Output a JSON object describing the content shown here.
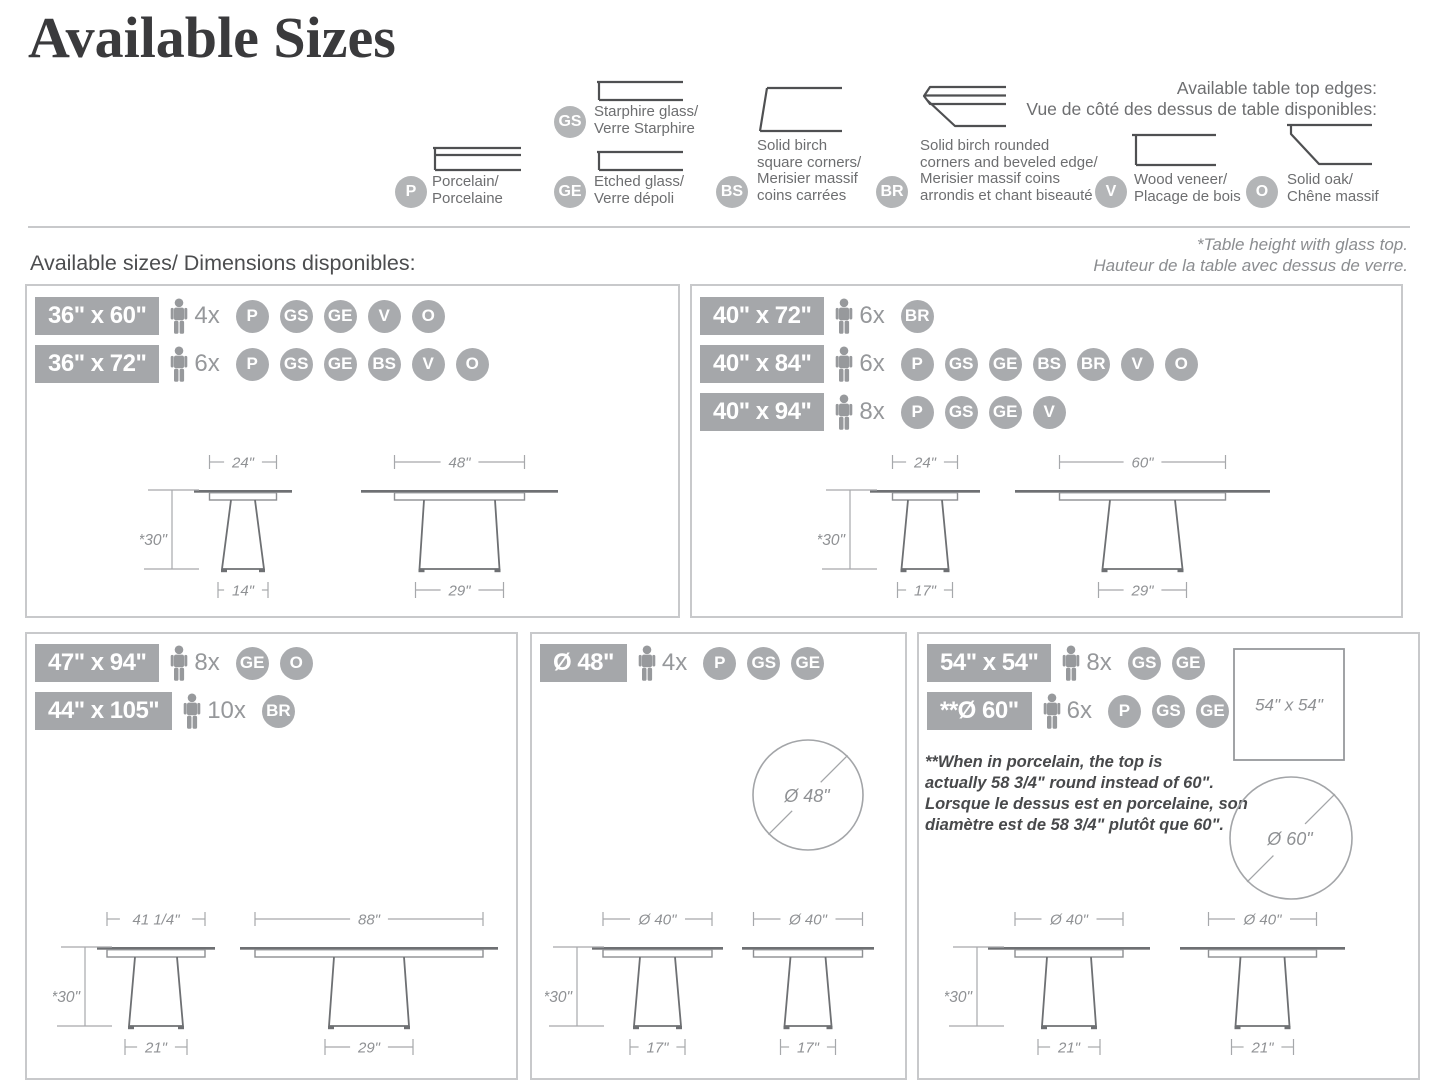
{
  "page": {
    "title": "Available Sizes",
    "section_label": "Available sizes/ Dimensions disponibles:",
    "footnote_line1": "*Table height with glass top.",
    "footnote_line2": "Hauteur de la table avec dessus de verre."
  },
  "edges_legend": {
    "heading_line1": "Available table top edges:",
    "heading_line2": "Vue de côté des dessus de table disponibles:",
    "items": [
      {
        "code": "P",
        "lines": [
          "Porcelain/",
          "Porcelaine"
        ]
      },
      {
        "code": "GS",
        "lines": [
          "Starphire glass/",
          "Verre Starphire"
        ]
      },
      {
        "code": "GE",
        "lines": [
          "Etched glass/",
          "Verre dépoli"
        ]
      },
      {
        "code": "BS",
        "lines": [
          "Solid birch",
          "square corners/",
          "Merisier massif",
          "coins carrées"
        ]
      },
      {
        "code": "BR",
        "lines": [
          "Solid birch rounded",
          "corners and beveled edge/",
          "Merisier massif coins",
          "arrondis et chant biseauté"
        ]
      },
      {
        "code": "V",
        "lines": [
          "Wood veneer/",
          "Placage de bois"
        ]
      },
      {
        "code": "O",
        "lines": [
          "Solid oak/",
          "Chêne massif"
        ]
      }
    ]
  },
  "panels": [
    {
      "rows": [
        {
          "size": "36\" x 60\"",
          "seats": "4x",
          "finishes": [
            "P",
            "GS",
            "GE",
            "V",
            "O"
          ]
        },
        {
          "size": "36\" x 72\"",
          "seats": "6x",
          "finishes": [
            "P",
            "GS",
            "GE",
            "BS",
            "V",
            "O"
          ]
        }
      ],
      "drawings": [
        {
          "type": "pedestal",
          "top": "24\"",
          "height": "*30\"",
          "base": "14\""
        },
        {
          "type": "pedestal",
          "top": "48\"",
          "base": "29\""
        }
      ]
    },
    {
      "rows": [
        {
          "size": "40\" x 72\"",
          "seats": "6x",
          "finishes": [
            "BR"
          ]
        },
        {
          "size": "40\" x 84\"",
          "seats": "6x",
          "finishes": [
            "P",
            "GS",
            "GE",
            "BS",
            "BR",
            "V",
            "O"
          ]
        },
        {
          "size": "40\" x 94\"",
          "seats": "8x",
          "finishes": [
            "P",
            "GS",
            "GE",
            "V"
          ]
        }
      ],
      "drawings": [
        {
          "type": "pedestal",
          "top": "24\"",
          "height": "*30\"",
          "base": "17\""
        },
        {
          "type": "pedestal",
          "top": "60\"",
          "base": "29\""
        }
      ]
    },
    {
      "rows": [
        {
          "size": "47\" x 94\"",
          "seats": "8x",
          "finishes": [
            "GE",
            "O"
          ]
        },
        {
          "size": "44\" x 105\"",
          "seats": "10x",
          "finishes": [
            "BR"
          ]
        }
      ],
      "drawings": [
        {
          "type": "pedestal",
          "top": "41 1/4\"",
          "height": "*30\"",
          "base": "21\""
        },
        {
          "type": "pedestal",
          "top": "88\"",
          "base": "29\""
        }
      ]
    },
    {
      "rows": [
        {
          "size": "Ø 48\"",
          "seats": "4x",
          "finishes": [
            "P",
            "GS",
            "GE"
          ]
        }
      ],
      "drawings": [
        {
          "type": "circle",
          "label": "Ø 48\""
        },
        {
          "type": "pedestal",
          "top": "Ø 40\"",
          "height": "*30\"",
          "base": "17\""
        },
        {
          "type": "pedestal",
          "top": "Ø 40\"",
          "base": "17\""
        }
      ]
    },
    {
      "rows": [
        {
          "size": "54\" x 54\"",
          "seats": "8x",
          "finishes": [
            "GS",
            "GE"
          ]
        },
        {
          "size": "**Ø 60\"",
          "seats": "6x",
          "finishes": [
            "P",
            "GS",
            "GE"
          ]
        }
      ],
      "note_lines": [
        "**When in porcelain, the top is",
        "actually 58 3/4\" round instead of 60\".",
        "Lorsque le dessus est en porcelaine, son",
        "diamètre est de 58 3/4\" plutôt que 60\"."
      ],
      "drawings": [
        {
          "type": "square",
          "label": "54\" x 54\""
        },
        {
          "type": "circle",
          "label": "Ø 60\""
        },
        {
          "type": "pedestal",
          "top": "Ø 40\"",
          "height": "*30\"",
          "base": "21\""
        },
        {
          "type": "pedestal",
          "top": "Ø 40\"",
          "base": "21\""
        }
      ]
    }
  ],
  "colors": {
    "chip_gray": "#a5a7aa",
    "badge_gray": "#a9abae",
    "legend_circle_gray": "#b3b5b7",
    "drawing_line": "#6e7073",
    "dimension_line": "#a6a8ab",
    "text_gray": "#6d6e70",
    "title_color": "#3a3a3c"
  }
}
